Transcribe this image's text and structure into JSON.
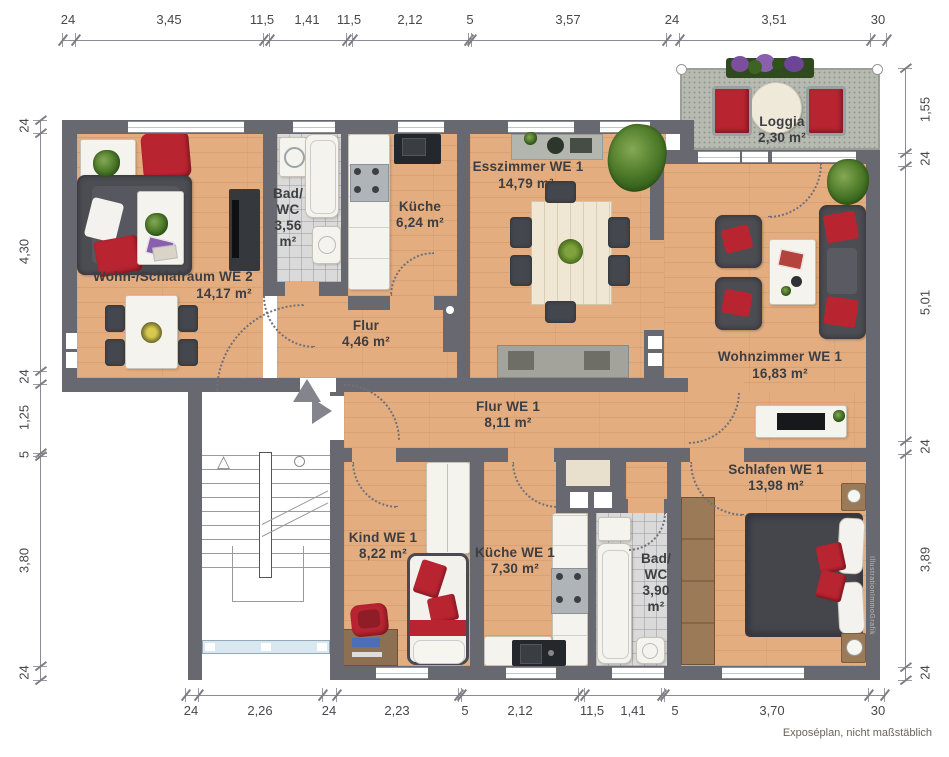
{
  "meta": {
    "note": "Exposéplan, nicht maßstäblich",
    "watermark": "IllustrationImmoGrafik"
  },
  "rooms": {
    "we2_room": {
      "label": "Wohn-/Schlafraum WE 2",
      "area": "14,17 m²"
    },
    "we2_bad": {
      "l1": "Bad/",
      "l2": "WC",
      "l3": "3,56",
      "l4": "m²"
    },
    "we2_kueche": {
      "label": "Küche",
      "area": "6,24 m²"
    },
    "we2_flur": {
      "label": "Flur",
      "area": "4,46 m²"
    },
    "esszimmer": {
      "label": "Esszimmer WE 1",
      "area": "14,79 m²"
    },
    "loggia": {
      "label": "Loggia",
      "area": "2,30 m²"
    },
    "wohnzimmer": {
      "label": "Wohnzimmer WE 1",
      "area": "16,83 m²"
    },
    "flur_we1": {
      "label": "Flur WE 1",
      "area": "8,11 m²"
    },
    "kind": {
      "label": "Kind WE 1",
      "area": "8,22 m²"
    },
    "kueche_we1": {
      "label": "Küche WE 1",
      "area": "7,30 m²"
    },
    "bad_we1": {
      "l1": "Bad/",
      "l2": "WC",
      "l3": "3,90",
      "l4": "m²"
    },
    "schlafen": {
      "label": "Schlafen WE 1",
      "area": "13,98 m²"
    }
  },
  "dims": {
    "top": [
      "24",
      "3,45",
      "11,5",
      "1,41",
      "11,5",
      "2,12",
      "5",
      "3,57",
      "24",
      "3,51",
      "30"
    ],
    "bottom": [
      "24",
      "2,26",
      "24",
      "2,23",
      "5",
      "2,12",
      "11,5",
      "1,41",
      "5",
      "3,70",
      "30"
    ],
    "left": [
      "24",
      "4,30",
      "24",
      "1,25",
      "5",
      "3,80",
      "24"
    ],
    "right": [
      "1,55",
      "24",
      "5,01",
      "24",
      "3,89",
      "24"
    ]
  },
  "colors": {
    "wall": "#686871",
    "wood": "#e3ad80",
    "tile": "#dadada",
    "loggia": "#b6bab0",
    "accent_red": "#b92431",
    "furniture_dark": "#4c4c53",
    "label_text": "#3d3e42"
  }
}
